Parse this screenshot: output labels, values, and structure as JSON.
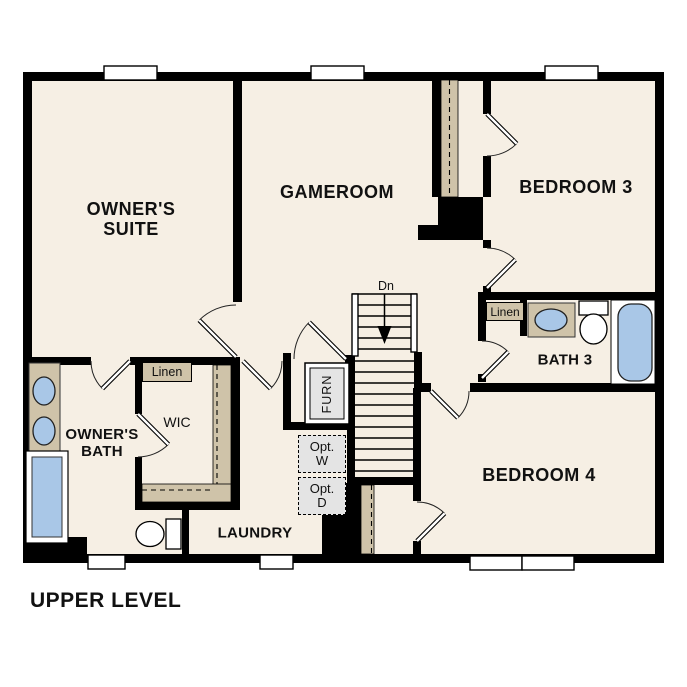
{
  "plan_title": "UPPER LEVEL",
  "stairs": {
    "direction_label": "Dn"
  },
  "rooms": {
    "owners_suite": "OWNER'S\nSUITE",
    "gameroom": "GAMEROOM",
    "bedroom3": "BEDROOM 3",
    "owners_bath": "OWNER'S\nBATH",
    "wic": "WIC",
    "bath3": "BATH 3",
    "bedroom4": "BEDROOM 4",
    "laundry": "LAUNDRY"
  },
  "closets": {
    "linen_hall": "Linen",
    "linen_bath3": "Linen"
  },
  "equipment": {
    "furnace": "FURN",
    "washer_opt": {
      "line1": "Opt.",
      "line2": "W"
    },
    "dryer_opt": {
      "line1": "Opt.",
      "line2": "D"
    }
  },
  "colors": {
    "background": "#ffffff",
    "floor": "#f6efe4",
    "wall": "#000000",
    "casework_tan": "#cfc3a9",
    "fixture_blue": "#a9c7e7",
    "equipment_gray": "#e4e4e4"
  },
  "fixture_icons": [
    "window",
    "door-swing",
    "stairs",
    "railing",
    "double-vanity-sink",
    "shower",
    "toilet",
    "bathtub",
    "single-vanity-sink",
    "furnace-unit",
    "closet-rod-shelf",
    "optional-washer",
    "optional-dryer"
  ]
}
